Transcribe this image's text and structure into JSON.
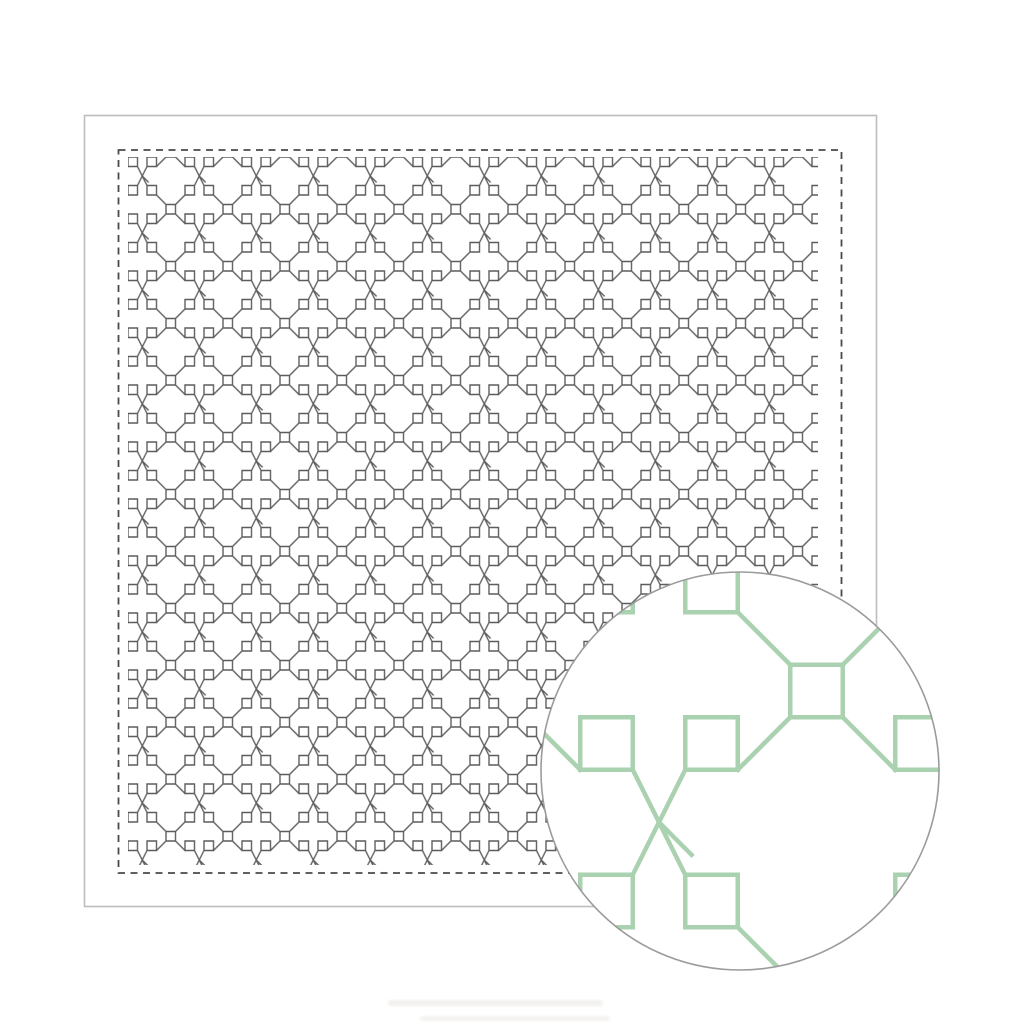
{
  "scene": {
    "subject": "sashiko-sampler-cloth",
    "detail_inset": "circular-magnified-swatch"
  },
  "colors": {
    "background": "#ffffff",
    "fabric_fill": "#ffffff",
    "fabric_border": "#bdbdbd",
    "dash_border": "#4a4a4a",
    "stitch_dark": "#3f3f3f",
    "detail_green": "#aad2b0",
    "detail_circle_fill": "#ffffff",
    "circle_border": "#9b9b9b",
    "watermark": "#e9e7e2"
  },
  "pattern": {
    "motif": "linked-squares-with-diagonal-cross-stitches",
    "small_square_px": 9.5,
    "small_tile_px": 57,
    "large_square_px": 52.5,
    "large_tile_px": 315,
    "dashed_border": "stitch guide line",
    "detail_circle_center": [
      740,
      771
    ],
    "detail_circle_radius": 199
  }
}
